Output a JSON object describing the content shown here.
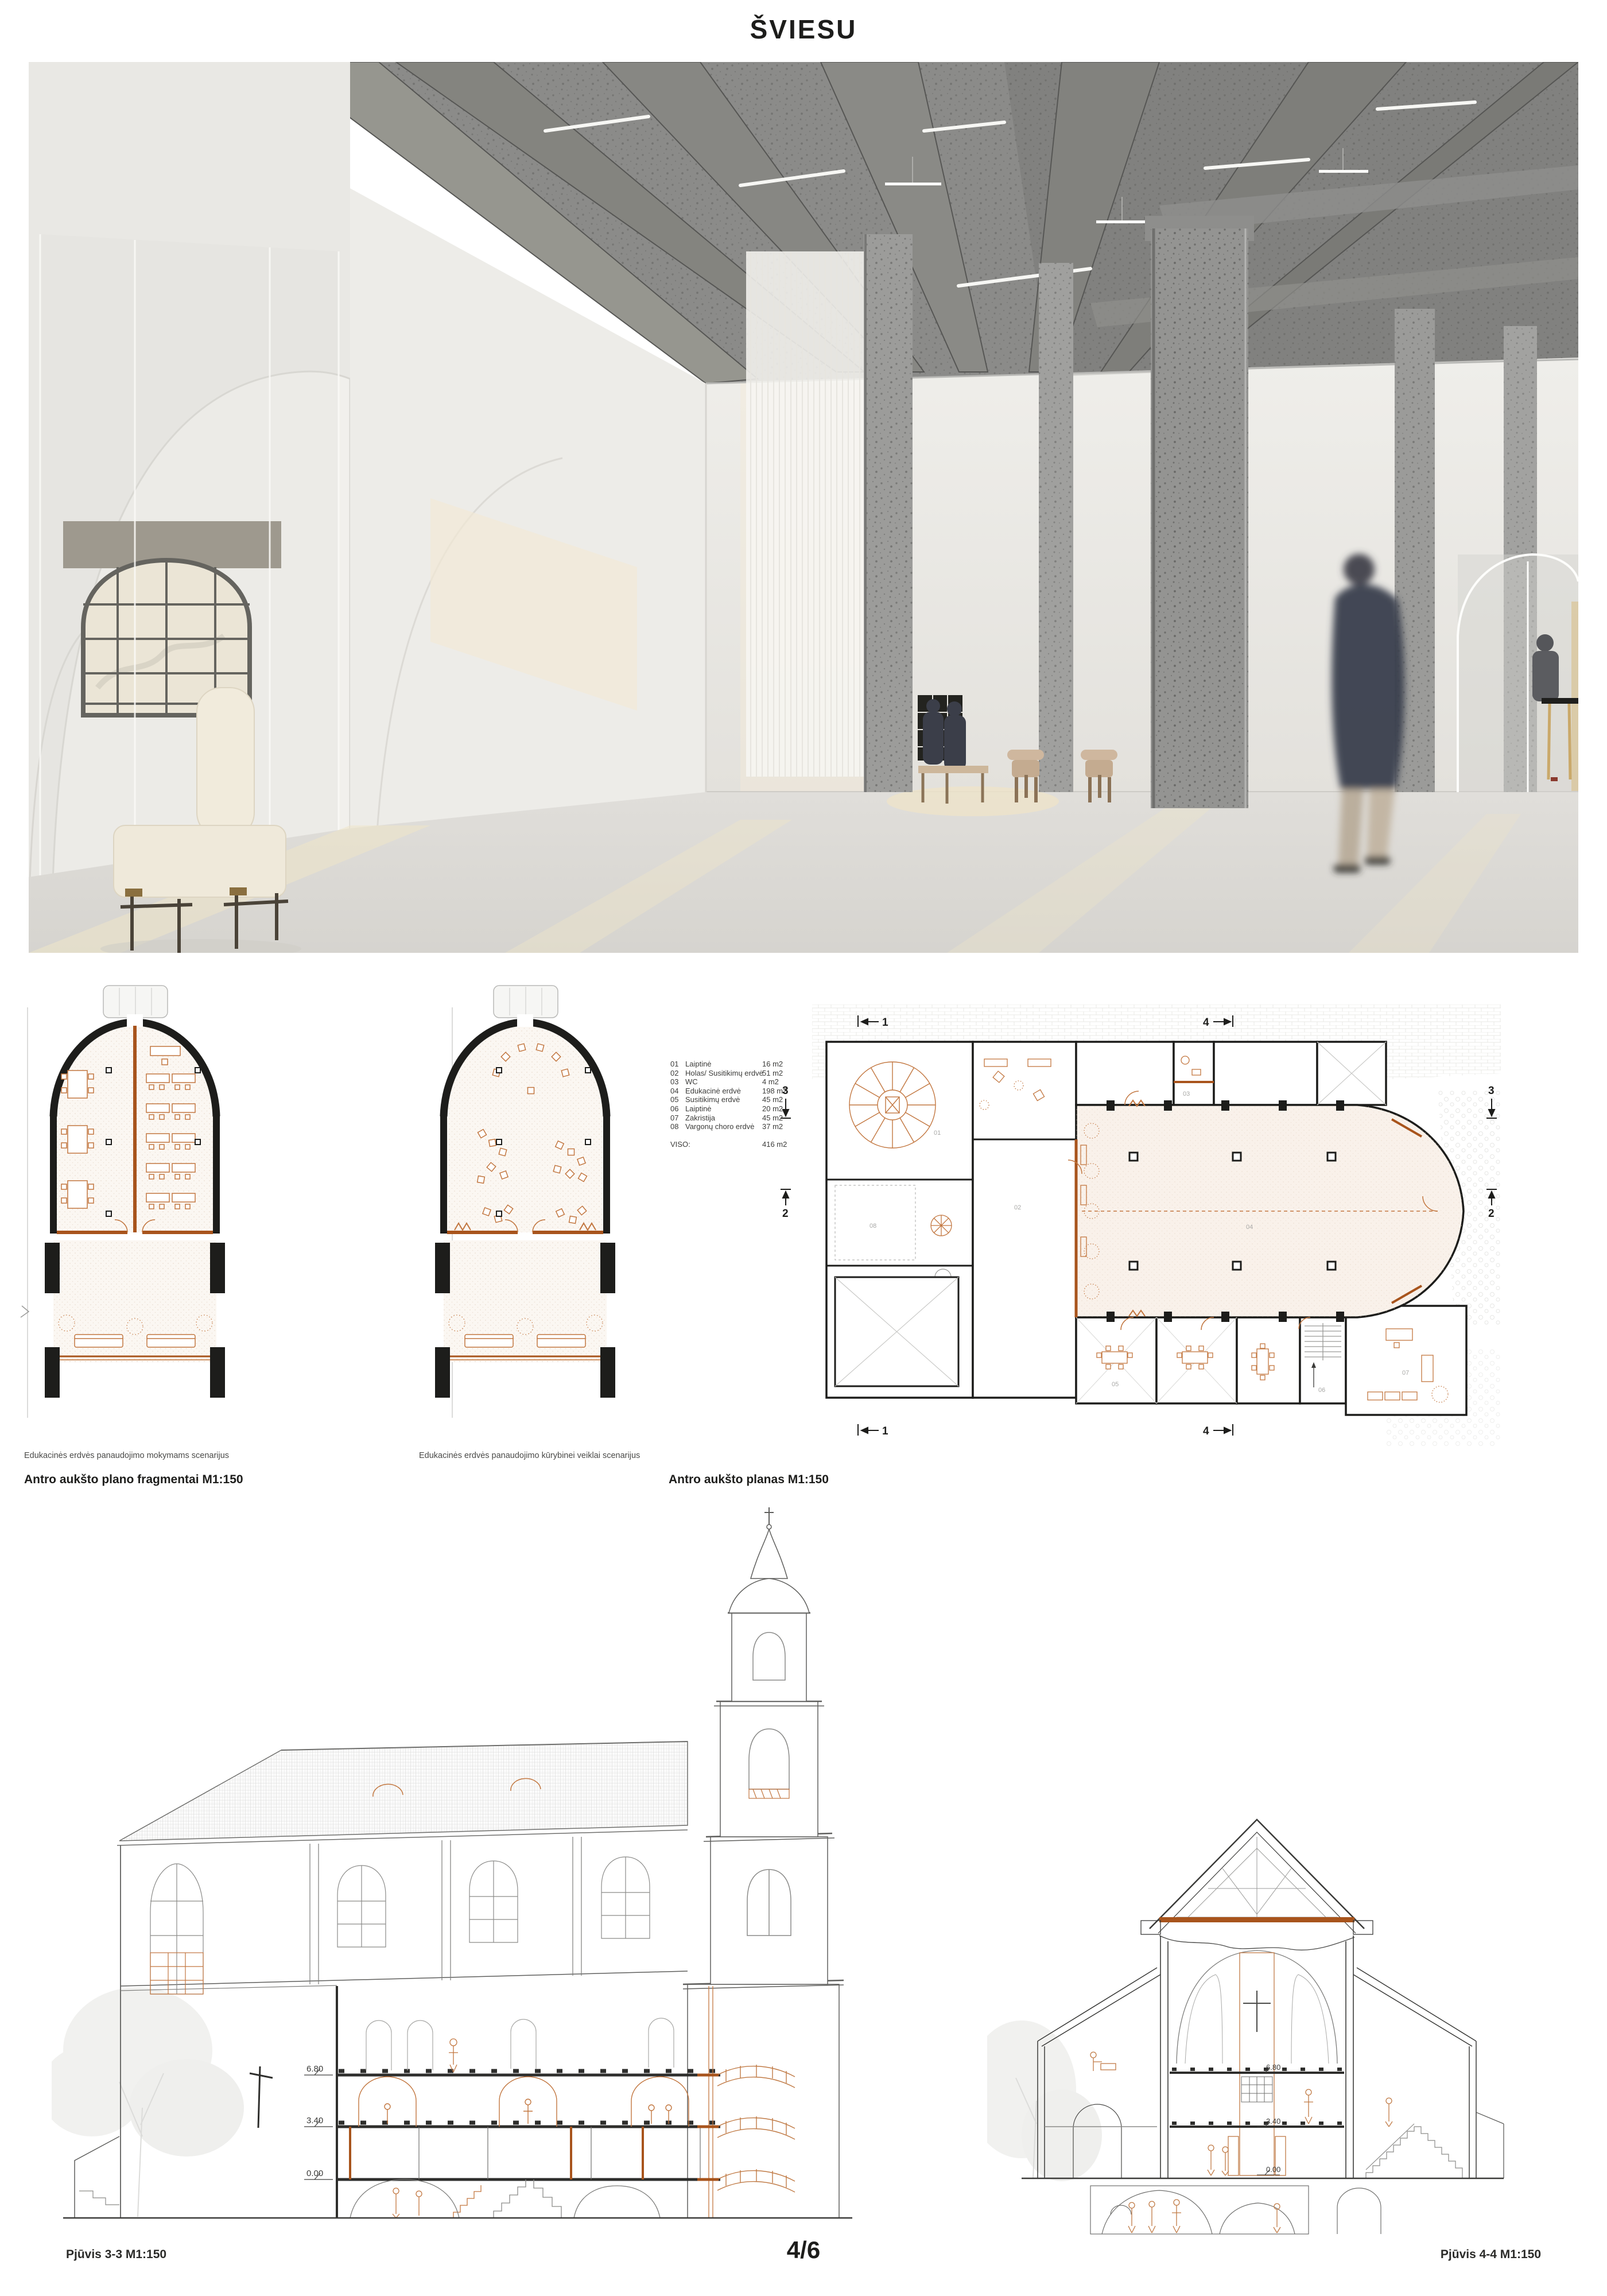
{
  "page": {
    "title": "ŠVIESU",
    "page_number": "4/6"
  },
  "colors": {
    "accent_orange": "#c2763f",
    "cut_orange": "#a8541c",
    "wall_black": "#1d1d1b",
    "concrete_gray": "#8f8f8d",
    "paper": "#ffffff"
  },
  "legend": {
    "rows": [
      {
        "code": "01",
        "name": "Laiptinė",
        "area": "16 m2"
      },
      {
        "code": "02",
        "name": "Holas/ Susitikimų erdvė",
        "area": "51 m2"
      },
      {
        "code": "03",
        "name": "WC",
        "area": "4 m2"
      },
      {
        "code": "04",
        "name": "Edukacinė erdvė",
        "area": "198 m2"
      },
      {
        "code": "05",
        "name": "Susitikimų erdvė",
        "area": "45 m2"
      },
      {
        "code": "06",
        "name": "Laiptinė",
        "area": "20 m2"
      },
      {
        "code": "07",
        "name": "Zakristija",
        "area": "45 m2"
      },
      {
        "code": "08",
        "name": "Vargonų choro erdvė",
        "area": "37 m2"
      }
    ],
    "total_label": "VISO:",
    "total_area": "416 m2"
  },
  "plans": {
    "fragment1_caption": "Edukacinės erdvės panaudojimo mokymams scenarijus",
    "fragment2_caption": "Edukacinės erdvės panaudojimo kūrybinei veiklai scenarijus",
    "fragments_title": "Antro aukšto plano fragmentai M1:150",
    "plan_title": "Antro aukšto planas M1:150",
    "markers": {
      "m1": "1",
      "m2": "2",
      "m3": "3",
      "m4": "4"
    },
    "rooms": {
      "r01": "01",
      "r02": "02",
      "r03": "03",
      "r04": "04",
      "r05": "05",
      "r06": "06",
      "r07": "07",
      "r08": "08"
    }
  },
  "sections": {
    "left_label": "Pjūvis 3-3 M1:150",
    "right_label": "Pjūvis 4-4 M1:150",
    "levels": [
      "6.80",
      "3.40",
      "0.00"
    ]
  }
}
